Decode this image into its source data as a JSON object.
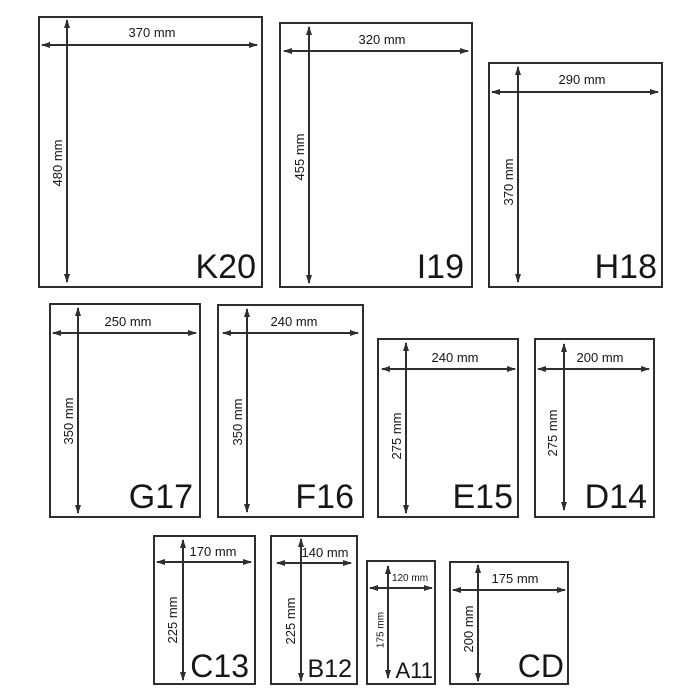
{
  "diagram": {
    "unit": "mm",
    "line_color": "#2e2e2e",
    "text_color": "#161616",
    "background": "#ffffff"
  },
  "envelopes": [
    {
      "name": "K20",
      "width_label": "370 mm",
      "height_label": "480 mm",
      "width_mm": 370,
      "height_mm": 480
    },
    {
      "name": "I19",
      "width_label": "320 mm",
      "height_label": "455 mm",
      "width_mm": 320,
      "height_mm": 455
    },
    {
      "name": "H18",
      "width_label": "290 mm",
      "height_label": "370 mm",
      "width_mm": 290,
      "height_mm": 370
    },
    {
      "name": "G17",
      "width_label": "250 mm",
      "height_label": "350 mm",
      "width_mm": 250,
      "height_mm": 350
    },
    {
      "name": "F16",
      "width_label": "240 mm",
      "height_label": "350 mm",
      "width_mm": 240,
      "height_mm": 350
    },
    {
      "name": "E15",
      "width_label": "240 mm",
      "height_label": "275 mm",
      "width_mm": 240,
      "height_mm": 275
    },
    {
      "name": "D14",
      "width_label": "200 mm",
      "height_label": "275 mm",
      "width_mm": 200,
      "height_mm": 275
    },
    {
      "name": "C13",
      "width_label": "170 mm",
      "height_label": "225 mm",
      "width_mm": 170,
      "height_mm": 225
    },
    {
      "name": "B12",
      "width_label": "140 mm",
      "height_label": "225 mm",
      "width_mm": 140,
      "height_mm": 225
    },
    {
      "name": "A11",
      "width_label": "120 mm",
      "height_label": "175 mm",
      "width_mm": 120,
      "height_mm": 175
    },
    {
      "name": "CD",
      "width_label": "175 mm",
      "height_label": "200 mm",
      "width_mm": 175,
      "height_mm": 200
    }
  ]
}
